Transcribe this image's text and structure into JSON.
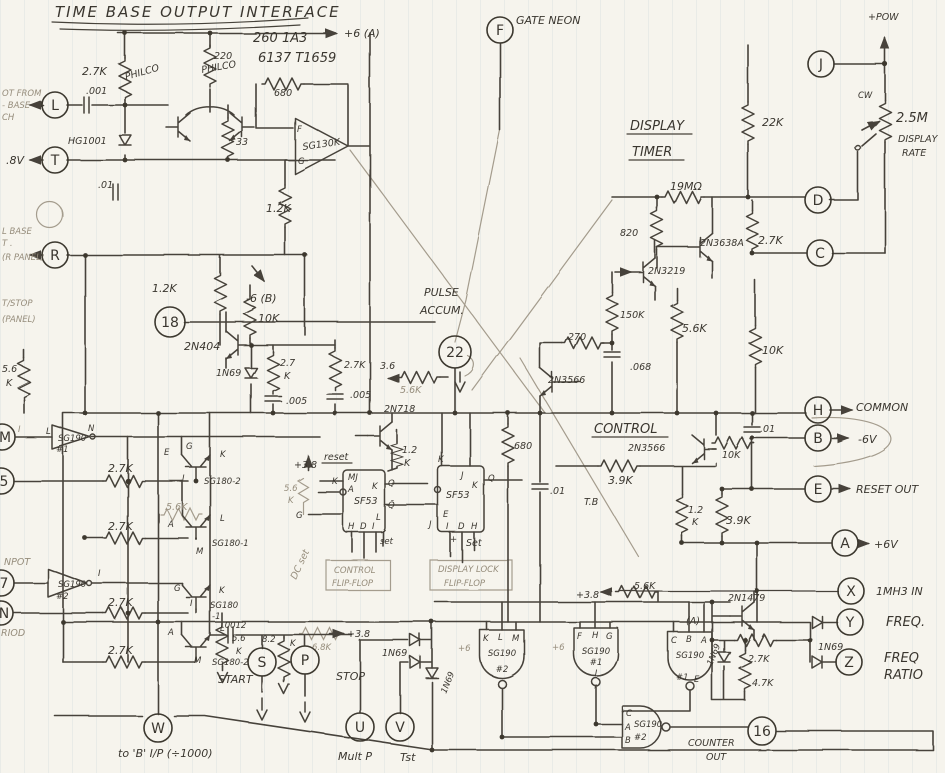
{
  "title": "TIME BASE OUTPUT INTERFACE",
  "colors": {
    "ink": "#3a362f",
    "pencil_light": "#968d7c",
    "paper": "#f6f4ed",
    "rule_line": "#cfdbe2"
  },
  "terminals": {
    "L": "L",
    "T": "T",
    "R": "R",
    "n18": "18",
    "M": "M",
    "n5": "5",
    "n7": "7",
    "N": "N",
    "W": "W",
    "S": "S",
    "P": "P",
    "U": "U",
    "V": "V",
    "F": "F",
    "J": "J",
    "D": "D",
    "C": "C",
    "H": "H",
    "B": "B",
    "E": "E",
    "A": "A",
    "X": "X",
    "Y": "Y",
    "Z": "Z",
    "n22": "22",
    "n16": "16"
  },
  "tl": {
    "pn1": "260 1A3",
    "pn2": "6137 T1659",
    "plus6a": "+6 (A)",
    "r27k": "2.7K",
    "r220": "220",
    "philco1": "PHILCO",
    "philco2": "PHILCO",
    "r680": "680",
    "amp_name": "SG130K",
    "amp_f": "F",
    "amp_g": "G",
    "cap001": ".001",
    "hg1001": "HG1001",
    "cap01": ".01",
    "r33": "33",
    "from1": "OT FROM",
    "from2": "- BASE",
    "from3": "CH",
    "v8": ".8V",
    "rp1": "L BASE",
    "rp2": "T .",
    "rp3": "(R PANEL)",
    "r12k_a": "1.2K",
    "r12k_b": "1.2K",
    "neg6b": "-6 (B)",
    "r10k": "10K",
    "st1": "T/STOP",
    "st2": "(PANEL)",
    "q404": "2N404",
    "d69": "1N69",
    "r27b1": "2.7",
    "r27b2": "K",
    "c005a": ".005",
    "e56a": "5.6",
    "e56b": "K",
    "r27p": "2.7K",
    "x36": "3.6",
    "c005b": ".005",
    "r56p": "5.6K",
    "pulse1": "PULSE",
    "pulse2": "ACCUM."
  },
  "tr": {
    "gate_neon": "GATE NEON",
    "pow": "+POW",
    "r22k": "22K",
    "cw": "CW",
    "pot": "2.5M",
    "rate1": "DISPLAY",
    "rate2": "RATE",
    "dt1": "DISPLAY",
    "dt2": "TIMER",
    "r19m": "19MΩ",
    "r820": "820",
    "q3638": "2N3638A",
    "r27k": "2.7K",
    "q3219": "2N3219",
    "r150k": "150K",
    "r56k": "5.6K",
    "r10k": "10K",
    "r270": "270",
    "c068": ".068",
    "q3566": "2N3566"
  },
  "mid": {
    "common": "COMMON",
    "control": "CONTROL",
    "q3566": "2N3566",
    "r10k": "10K",
    "cap01": ".01",
    "neg6v": "-6V",
    "q718": "2N718",
    "r12a": "1.2",
    "r12b": "K",
    "r39a": "3.9K",
    "reset_out": "RESET OUT",
    "tb": "T.B",
    "r12c": "1.2",
    "r12d": "K",
    "r39b": "3.9K",
    "plus6v": "+6V",
    "mhz": "1MH3 IN",
    "inv1": "SG190",
    "inv1n": "#1",
    "inv1L": "L",
    "inv1N": "N",
    "inv1I": "I",
    "inv2": "SG190",
    "inv2n": "#2",
    "inv2I": "I",
    "npot": "NPOT",
    "period": "RIOD",
    "r27_1": "2.7K",
    "r27_2": "2.7K",
    "r27_3": "2.7K",
    "r27_4": "2.7K",
    "r56a": "5.6K",
    "qa_e": "E",
    "qa_g": "G",
    "qa_k": "K",
    "qa_i": "I",
    "qa_name": "SG180-2",
    "qb_a": "A",
    "qb_l": "L",
    "qb_m": "M",
    "qb_name": "SG180-1",
    "qc_g": "G",
    "qc_k": "K",
    "qc_i": "I",
    "qc_name": "SG180",
    "qc_sfx": "-1",
    "qd_a": "A",
    "qd_l": "L",
    "qd_m": "M",
    "qd_name": "SG180-2"
  },
  "ff": {
    "reset": "reset",
    "p38": "+3.8",
    "r56_1": "5.6",
    "r56_2": "K",
    "g": "G",
    "dcset": "DC set",
    "f1name": "SF53",
    "f1k": "K",
    "f1mj": "MJ",
    "f1a": "A",
    "f1k2": "K",
    "f1q": "Q",
    "f1qb": "Q̄",
    "f1l": "L",
    "f1h": "H",
    "f1d": "D",
    "f1i": "I",
    "f1set": "set",
    "f2name": "SF53",
    "f2k": "K",
    "f2j": "J",
    "f2k2": "K",
    "f2q": "Q",
    "f2e": "E",
    "f2j2": "J",
    "f2i": "I",
    "f2d": "D",
    "f2h": "H",
    "f2plus": "+",
    "f2set": "Set",
    "r680": "680",
    "cap01": ".01",
    "cff1": "CONTROL",
    "cff2": "FLIP-FLOP",
    "dff1": "DISPLAY LOCK",
    "dff2": "FLIP-FLOP"
  },
  "bt": {
    "c0012": ".0012",
    "r82": "8.2",
    "r82k": "K",
    "r68k": "6.8K",
    "p38": "+3.8",
    "start": "START",
    "stop": "STOP",
    "d69a": "1N69",
    "tob": "to 'B' I/P (÷1000)",
    "multp": "Mult P",
    "tst": "Tst",
    "g56_1": "5.6",
    "g56_2": "K",
    "p38b": "+3.8",
    "r56k": "5.6K",
    "q1479": "2N1479",
    "tagA": "(A)",
    "r27k": "2.7K",
    "r47k": "4.7K",
    "d69b": "1N69",
    "d69c": "1N69",
    "freq": "FREQ.",
    "fr1": "FREQ",
    "fr2": "RATIO",
    "cnt1": "COUNTER",
    "cnt2": "OUT",
    "p6a": "+6",
    "p6b": "+6"
  },
  "gates": [
    {
      "p1": "K",
      "p2": "L",
      "p3": "M",
      "name": "SG190",
      "num": "#2"
    },
    {
      "p1": "F",
      "p2": "H",
      "p3": "G",
      "name": "SG190",
      "num": "#1",
      "out": "I"
    },
    {
      "p1": "C",
      "p2": "B",
      "p3": "A",
      "name": "SG190",
      "num": "#1",
      "out": "E"
    },
    {
      "p1": "C",
      "p2": "A",
      "p3": "B",
      "name": "SG190",
      "num": "#2"
    }
  ]
}
